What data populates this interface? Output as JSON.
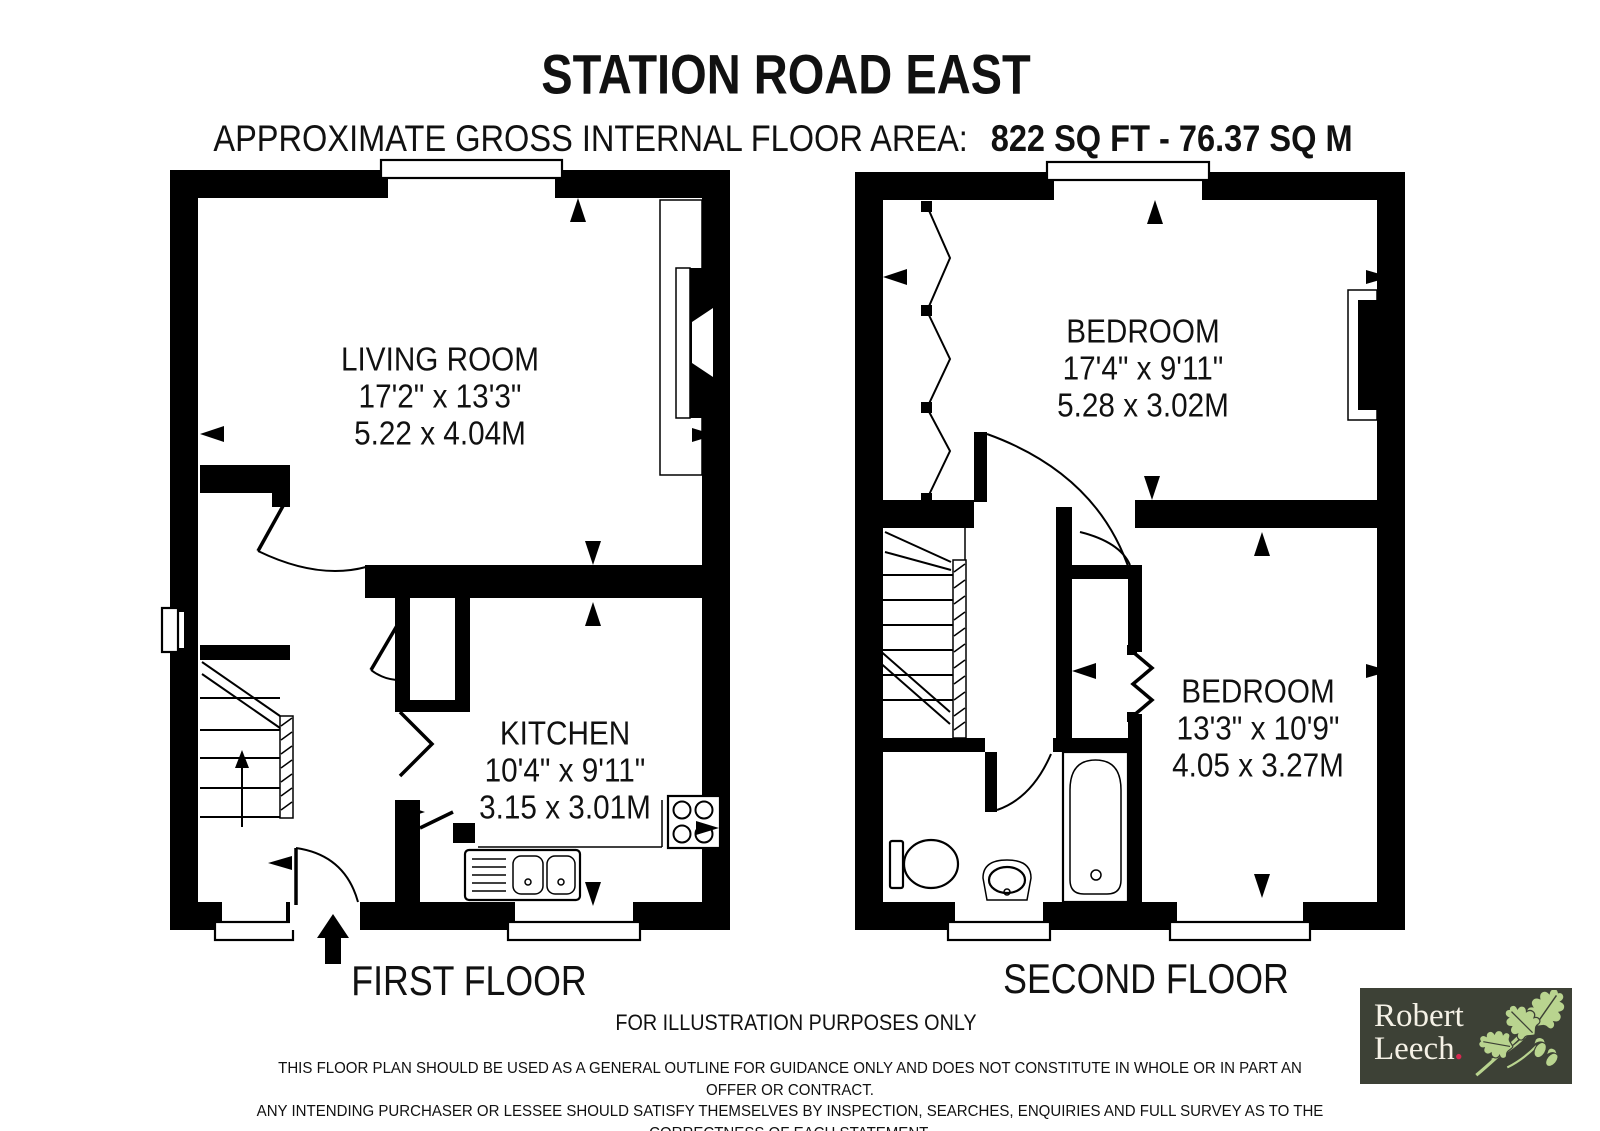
{
  "header": {
    "title": "STATION ROAD EAST",
    "area_label": "APPROXIMATE GROSS INTERNAL FLOOR AREA:",
    "area_value": "822 SQ FT - 76.37 SQ M"
  },
  "first_floor": {
    "label": "FIRST FLOOR",
    "living_room": {
      "name": "LIVING ROOM",
      "size_imperial": "17'2\" x 13'3\"",
      "size_metric": "5.22 x 4.04M"
    },
    "kitchen": {
      "name": "KITCHEN",
      "size_imperial": "10'4\" x 9'11\"",
      "size_metric": "3.15 x 3.01M"
    }
  },
  "second_floor": {
    "label": "SECOND FLOOR",
    "bedroom_1": {
      "name": "BEDROOM",
      "size_imperial": "17'4\" x 9'11\"",
      "size_metric": "5.28 x 3.02M"
    },
    "bedroom_2": {
      "name": "BEDROOM",
      "size_imperial": "13'3\" x 10'9\"",
      "size_metric": "4.05 x 3.27M"
    }
  },
  "footer": {
    "note": "FOR ILLUSTRATION PURPOSES ONLY",
    "disclaimer": [
      "THIS FLOOR PLAN SHOULD BE USED AS A GENERAL OUTLINE FOR GUIDANCE ONLY AND DOES NOT CONSTITUTE IN WHOLE OR IN PART AN OFFER OR CONTRACT.",
      "ANY INTENDING PURCHASER OR LESSEE SHOULD SATISFY THEMSELVES BY INSPECTION, SEARCHES, ENQUIRIES AND FULL SURVEY AS TO THE CORRECTNESS OF EACH STATEMENT.",
      "ANY AREAS, MEASUREMENTS OR DISTANCES QUOTED ARE APPROXIMATE AND SHOULD NOT BE USED TO VALUE A PROPERTY OR BE THE BASIS OF ANY SALE OR LET."
    ]
  },
  "logo": {
    "name_line1": "Robert",
    "name_line2": "Leech",
    "dot": "."
  },
  "colors": {
    "plan_ink": "#000000",
    "logo_bg": "#3d4136",
    "logo_text": "#f5f1e6",
    "logo_dot": "#d62850",
    "logo_leaf": "#b9d48f"
  }
}
